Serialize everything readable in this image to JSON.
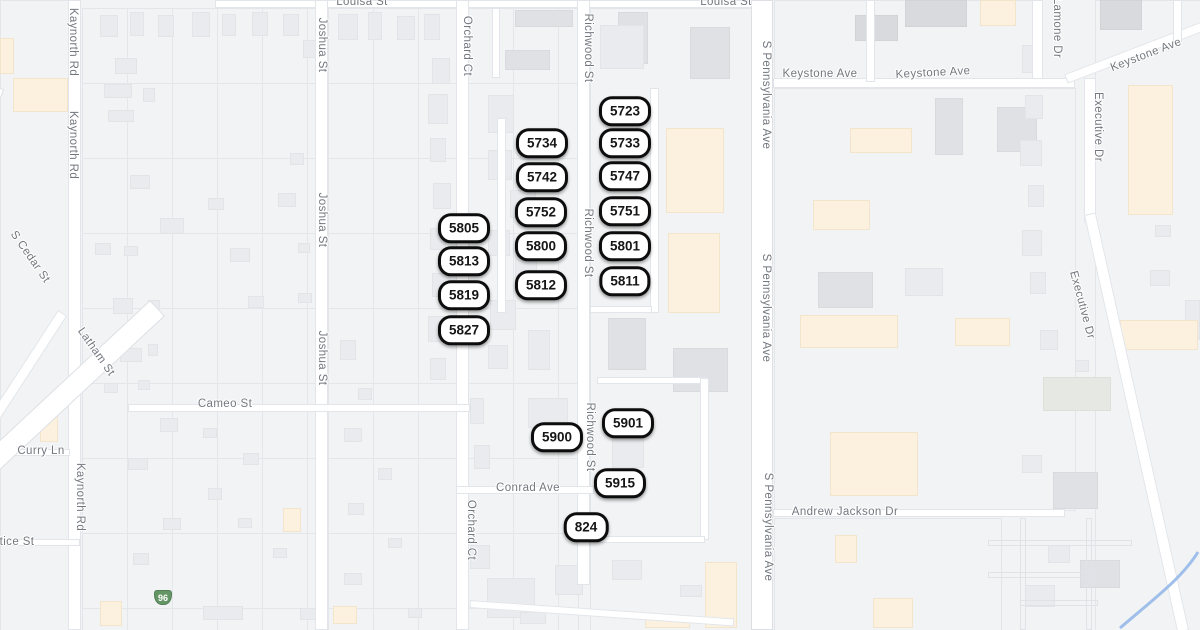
{
  "map": {
    "colors": {
      "background": "#f1f3f4",
      "road_fill": "#ffffff",
      "road_casing": "#e2e5e9",
      "building_gray": "#e9ebee",
      "building_dark": "#d8dadd",
      "building_commercial": "#fcf0de",
      "label_text": "#73777f",
      "marker_border": "#0d0d0d",
      "marker_fill": "#ffffff",
      "shield_green": "#649565",
      "stream_blue": "#9fbfea"
    },
    "street_labels": [
      {
        "text": "Louisa St",
        "x": 362,
        "y": 2,
        "rot": 0
      },
      {
        "text": "Louisa St",
        "x": 726,
        "y": 2,
        "rot": 0
      },
      {
        "text": "Kaynorth Rd",
        "x": 73,
        "y": 42,
        "rot": 90
      },
      {
        "text": "Kaynorth Rd",
        "x": 73,
        "y": 145,
        "rot": 90
      },
      {
        "text": "Kaynorth Rd",
        "x": 80,
        "y": 497,
        "rot": 90
      },
      {
        "text": "Joshua St",
        "x": 322,
        "y": 45,
        "rot": 90
      },
      {
        "text": "Joshua St",
        "x": 322,
        "y": 220,
        "rot": 90
      },
      {
        "text": "Joshua St",
        "x": 322,
        "y": 358,
        "rot": 90
      },
      {
        "text": "Orchard Ct",
        "x": 467,
        "y": 46,
        "rot": 90
      },
      {
        "text": "Orchard Ct",
        "x": 471,
        "y": 530,
        "rot": 90
      },
      {
        "text": "Richwood St",
        "x": 588,
        "y": 48,
        "rot": 90
      },
      {
        "text": "Richwood St",
        "x": 588,
        "y": 243,
        "rot": 90
      },
      {
        "text": "Richwood St",
        "x": 590,
        "y": 437,
        "rot": 90
      },
      {
        "text": "S Pennsylvania Ave",
        "x": 766,
        "y": 95,
        "rot": 90
      },
      {
        "text": "S Pennsylvania Ave",
        "x": 766,
        "y": 308,
        "rot": 90
      },
      {
        "text": "S Pennsylvania Ave",
        "x": 768,
        "y": 527,
        "rot": 90
      },
      {
        "text": "S Cedar St",
        "x": 30,
        "y": 257,
        "rot": 55
      },
      {
        "text": "Latham St",
        "x": 96,
        "y": 352,
        "rot": 55
      },
      {
        "text": "Cameo St",
        "x": 225,
        "y": 404,
        "rot": 0
      },
      {
        "text": "Curry Ln",
        "x": 41,
        "y": 451,
        "rot": 0
      },
      {
        "text": "tice St",
        "x": 17,
        "y": 542,
        "rot": 0
      },
      {
        "text": "Conrad Ave",
        "x": 528,
        "y": 488,
        "rot": 0
      },
      {
        "text": "Keystone Ave",
        "x": 820,
        "y": 74,
        "rot": 0
      },
      {
        "text": "Keystone Ave",
        "x": 933,
        "y": 73,
        "rot": -3
      },
      {
        "text": "Keystone Ave",
        "x": 1146,
        "y": 55,
        "rot": -21
      },
      {
        "text": "Lamone Dr",
        "x": 1057,
        "y": 28,
        "rot": 90
      },
      {
        "text": "Executive Dr",
        "x": 1098,
        "y": 127,
        "rot": 90
      },
      {
        "text": "Executive Dr",
        "x": 1082,
        "y": 305,
        "rot": 75
      },
      {
        "text": "Andrew Jackson Dr",
        "x": 845,
        "y": 512,
        "rot": 0
      }
    ],
    "address_markers": [
      {
        "label": "5723",
        "x": 625,
        "y": 111
      },
      {
        "label": "5734",
        "x": 542,
        "y": 143
      },
      {
        "label": "5733",
        "x": 625,
        "y": 143
      },
      {
        "label": "5742",
        "x": 542,
        "y": 177
      },
      {
        "label": "5747",
        "x": 625,
        "y": 176
      },
      {
        "label": "5752",
        "x": 541,
        "y": 212
      },
      {
        "label": "5751",
        "x": 625,
        "y": 211
      },
      {
        "label": "5805",
        "x": 464,
        "y": 228
      },
      {
        "label": "5800",
        "x": 541,
        "y": 246
      },
      {
        "label": "5801",
        "x": 625,
        "y": 246
      },
      {
        "label": "5813",
        "x": 464,
        "y": 261
      },
      {
        "label": "5812",
        "x": 541,
        "y": 285
      },
      {
        "label": "5811",
        "x": 625,
        "y": 281
      },
      {
        "label": "5819",
        "x": 464,
        "y": 295
      },
      {
        "label": "5827",
        "x": 464,
        "y": 330
      },
      {
        "label": "5901",
        "x": 628,
        "y": 423
      },
      {
        "label": "5900",
        "x": 557,
        "y": 437
      },
      {
        "label": "5915",
        "x": 620,
        "y": 483
      },
      {
        "label": "824",
        "x": 586,
        "y": 527
      }
    ],
    "highway_shield": {
      "label": "96",
      "x": 163,
      "y": 597
    }
  }
}
